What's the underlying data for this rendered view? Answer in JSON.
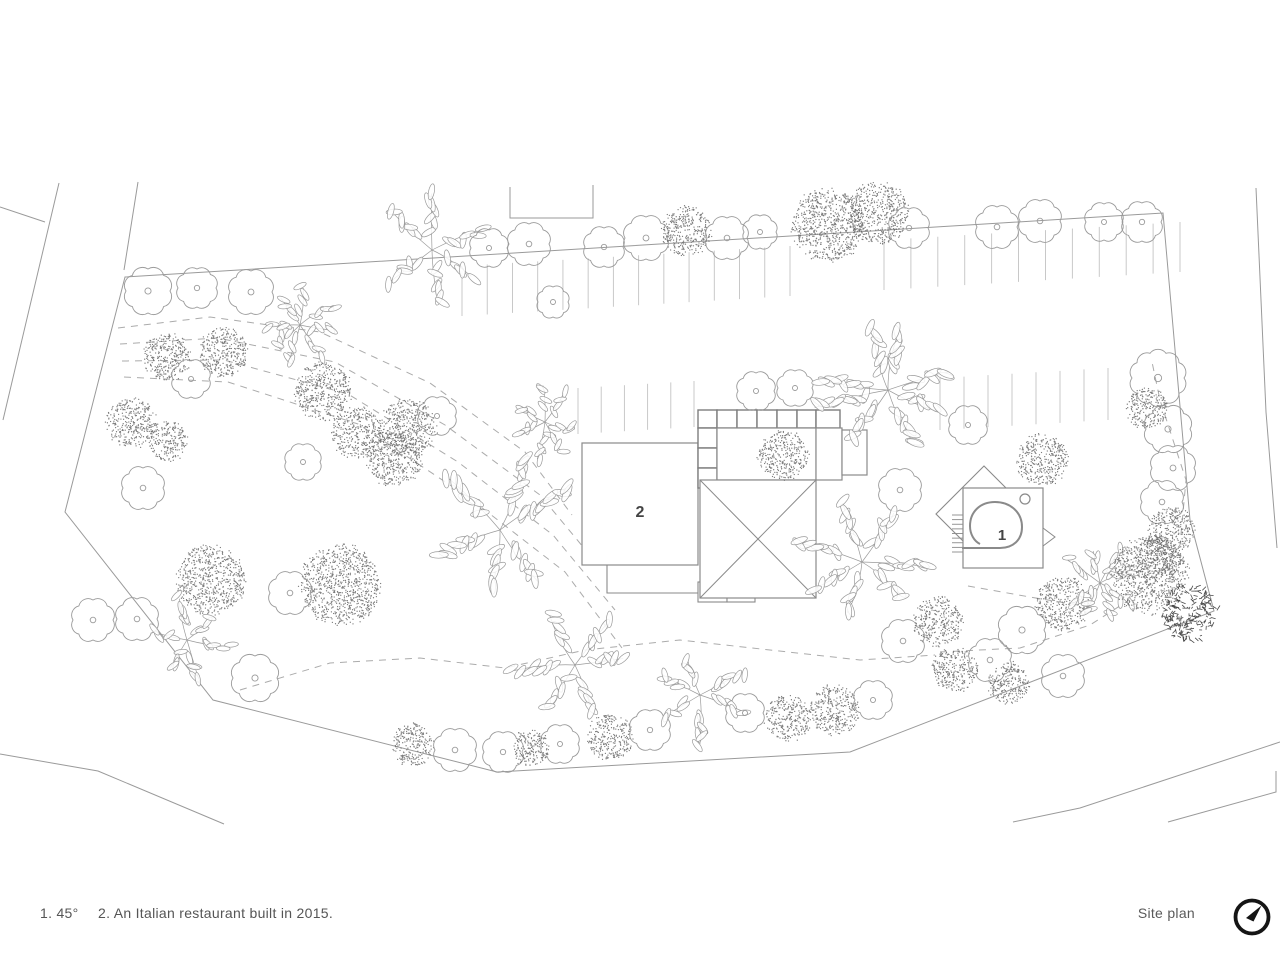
{
  "footer": {
    "note1": "1. 45°",
    "note2": "2. An Italian restaurant built in 2015.",
    "title": "Site plan",
    "north_icon": "north-arrow"
  },
  "colors": {
    "line": "#9a9a9a",
    "building_line": "#8a8a8a",
    "grid_line": "#7d7d7d",
    "parking": "#c3c3c3",
    "dash": "#ababab",
    "stipple": "#666666",
    "dark_tree": "#4a4a4a",
    "label_text": "#444444",
    "footer_text": "#555555",
    "north": "#151515",
    "background": "#ffffff"
  },
  "plan": {
    "boundary": [
      [
        125,
        277
      ],
      [
        1163,
        213
      ],
      [
        1190,
        520
      ],
      [
        1214,
        611
      ],
      [
        850,
        752
      ],
      [
        497,
        772
      ],
      [
        213,
        700
      ],
      [
        65,
        512
      ]
    ],
    "boundary_ext": [
      [
        138,
        182
      ],
      [
        124,
        270
      ]
    ],
    "roads": [
      [
        [
          59,
          183
        ],
        [
          3,
          420
        ]
      ],
      [
        [
          0,
          207
        ],
        [
          45,
          222
        ]
      ],
      [
        [
          0,
          754
        ],
        [
          98,
          771
        ],
        [
          224,
          824
        ]
      ],
      [
        [
          1013,
          822
        ],
        [
          1080,
          808
        ],
        [
          1280,
          742
        ]
      ],
      [
        [
          1168,
          822
        ],
        [
          1276,
          792
        ],
        [
          1276,
          771
        ]
      ],
      [
        [
          1256,
          188
        ],
        [
          1261,
          300
        ],
        [
          1266,
          412
        ],
        [
          1277,
          548
        ]
      ]
    ],
    "entry_u": [
      [
        510,
        187
      ],
      [
        510,
        218
      ],
      [
        593,
        218
      ],
      [
        593,
        185
      ]
    ],
    "parking": [
      {
        "from": [
          462,
          266
        ],
        "to": [
          790,
          246
        ],
        "n": 13,
        "len": 50
      },
      {
        "from": [
          884,
          240
        ],
        "to": [
          1180,
          222
        ],
        "n": 11,
        "len": 50
      },
      {
        "from": [
          578,
          388
        ],
        "to": [
          694,
          381
        ],
        "n": 5,
        "len": 46
      },
      {
        "from": [
          940,
          378
        ],
        "to": [
          1108,
          368
        ],
        "n": 7,
        "len": 52
      }
    ],
    "paths": [
      [
        [
          118,
          328
        ],
        [
          210,
          317
        ],
        [
          320,
          332
        ],
        [
          430,
          383
        ],
        [
          525,
          452
        ],
        [
          572,
          515
        ]
      ],
      [
        [
          120,
          344
        ],
        [
          218,
          338
        ],
        [
          335,
          362
        ],
        [
          445,
          425
        ],
        [
          540,
          495
        ],
        [
          598,
          565
        ]
      ],
      [
        [
          122,
          361
        ],
        [
          224,
          360
        ],
        [
          348,
          394
        ],
        [
          458,
          462
        ],
        [
          553,
          535
        ],
        [
          615,
          610
        ]
      ],
      [
        [
          124,
          377
        ],
        [
          228,
          382
        ],
        [
          358,
          424
        ],
        [
          468,
          497
        ],
        [
          565,
          572
        ],
        [
          622,
          648
        ]
      ],
      [
        [
          240,
          690
        ],
        [
          330,
          663
        ],
        [
          420,
          658
        ],
        [
          505,
          668
        ],
        [
          585,
          650
        ],
        [
          680,
          640
        ],
        [
          770,
          650
        ],
        [
          860,
          660
        ],
        [
          935,
          655
        ]
      ],
      [
        [
          940,
          652
        ],
        [
          1020,
          648
        ],
        [
          1090,
          625
        ],
        [
          1145,
          590
        ],
        [
          1180,
          545
        ],
        [
          1186,
          480
        ],
        [
          1160,
          400
        ],
        [
          1152,
          362
        ]
      ],
      [
        [
          968,
          586
        ],
        [
          1030,
          597
        ],
        [
          1090,
          607
        ]
      ]
    ],
    "building2": {
      "label": "2",
      "label_pos": [
        640,
        517
      ],
      "rect": [
        582,
        443,
        116,
        122
      ],
      "step": [
        [
          607,
          565
        ],
        [
          607,
          593
        ],
        [
          698,
          593
        ]
      ],
      "cells": [
        [
          698,
          582,
          29,
          20
        ],
        [
          727,
          582,
          28,
          20
        ]
      ]
    },
    "grid_building": {
      "top_cells_x": [
        698,
        717,
        737,
        757,
        777,
        797,
        816,
        840
      ],
      "top_cells_y": [
        410,
        428
      ],
      "left_cells_x": [
        698,
        717
      ],
      "left_cells_y": [
        428,
        448,
        468,
        488
      ],
      "courtyard": [
        717,
        428,
        99,
        52
      ],
      "right_wing": [
        816,
        428,
        26,
        52
      ],
      "annex": [
        842,
        430,
        25,
        45
      ],
      "roof_rect": [
        700,
        480,
        116,
        118
      ],
      "roof_apex": [
        758,
        539
      ],
      "courtyard_tree": [
        783,
        455,
        26
      ]
    },
    "building1": {
      "label": "1",
      "label_pos": [
        1002,
        540
      ],
      "diamond_center": [
        984,
        514
      ],
      "diamond_half": 48,
      "square": [
        963,
        488,
        80,
        80
      ],
      "circle": [
        1025,
        499,
        5
      ],
      "spiral": "M 962 548 L 1000 548 C 1013 548 1022 540 1022 527 C 1022 512 1010 502 995 502 C 980 502 970 512 970 526 C 970 534 974 541 980 544",
      "stairs": {
        "x1": 952,
        "x2": 963,
        "y1": 515,
        "y2": 552,
        "n": 8
      },
      "triangle": [
        [
          1043,
          528
        ],
        [
          1043,
          546
        ],
        [
          1055,
          537
        ]
      ]
    },
    "trees": [
      [
        "o",
        148,
        291,
        22
      ],
      [
        "o",
        197,
        288,
        19
      ],
      [
        "o",
        251,
        292,
        21
      ],
      [
        "l",
        432,
        250,
        58
      ],
      [
        "o",
        489,
        248,
        18
      ],
      [
        "o",
        529,
        244,
        20
      ],
      [
        "o",
        553,
        302,
        15
      ],
      [
        "o",
        604,
        247,
        19
      ],
      [
        "o",
        646,
        238,
        21
      ],
      [
        "s",
        686,
        231,
        26
      ],
      [
        "o",
        727,
        238,
        20
      ],
      [
        "o",
        760,
        232,
        16
      ],
      [
        "s",
        828,
        225,
        38
      ],
      [
        "s",
        878,
        213,
        32
      ],
      [
        "o",
        909,
        228,
        19
      ],
      [
        "o",
        997,
        227,
        20
      ],
      [
        "o",
        1040,
        221,
        20
      ],
      [
        "o",
        1104,
        222,
        18
      ],
      [
        "o",
        1142,
        222,
        19
      ],
      [
        "s",
        131,
        423,
        26
      ],
      [
        "s",
        167,
        357,
        25
      ],
      [
        "s",
        223,
        352,
        26
      ],
      [
        "o",
        191,
        379,
        18
      ],
      [
        "s",
        168,
        442,
        21
      ],
      [
        "o",
        143,
        488,
        20
      ],
      [
        "s",
        210,
        580,
        36
      ],
      [
        "s",
        340,
        585,
        42
      ],
      [
        "o",
        290,
        593,
        20
      ],
      [
        "o",
        93,
        620,
        20
      ],
      [
        "o",
        137,
        619,
        20
      ],
      [
        "l",
        187,
        640,
        42
      ],
      [
        "o",
        255,
        678,
        22
      ],
      [
        "l",
        300,
        325,
        40
      ],
      [
        "s",
        323,
        391,
        30
      ],
      [
        "s",
        357,
        433,
        27
      ],
      [
        "s",
        394,
        459,
        29
      ],
      [
        "o",
        303,
        462,
        17
      ],
      [
        "s",
        408,
        428,
        30
      ],
      [
        "o",
        437,
        416,
        18
      ],
      [
        "l",
        545,
        422,
        36
      ],
      [
        "l",
        500,
        530,
        78
      ],
      [
        "l",
        575,
        665,
        62
      ],
      [
        "s",
        413,
        745,
        22
      ],
      [
        "o",
        455,
        750,
        20
      ],
      [
        "o",
        503,
        752,
        19
      ],
      [
        "s",
        530,
        748,
        20
      ],
      [
        "o",
        560,
        744,
        18
      ],
      [
        "s",
        610,
        737,
        24
      ],
      [
        "o",
        650,
        730,
        19
      ],
      [
        "l",
        700,
        695,
        48
      ],
      [
        "o",
        745,
        713,
        18
      ],
      [
        "s",
        788,
        718,
        24
      ],
      [
        "s",
        835,
        710,
        26
      ],
      [
        "o",
        873,
        700,
        18
      ],
      [
        "o",
        756,
        391,
        18
      ],
      [
        "o",
        795,
        388,
        17
      ],
      [
        "l",
        888,
        390,
        72
      ],
      [
        "o",
        968,
        425,
        18
      ],
      [
        "s",
        1043,
        460,
        27
      ],
      [
        "o",
        900,
        490,
        20
      ],
      [
        "l",
        862,
        562,
        66
      ],
      [
        "s",
        938,
        622,
        26
      ],
      [
        "o",
        903,
        641,
        20
      ],
      [
        "s",
        955,
        670,
        24
      ],
      [
        "o",
        990,
        660,
        20
      ],
      [
        "s",
        1008,
        683,
        22
      ],
      [
        "o",
        1022,
        630,
        22
      ],
      [
        "s",
        1063,
        603,
        28
      ],
      [
        "l",
        1100,
        583,
        40
      ],
      [
        "s",
        1150,
        575,
        40
      ],
      [
        "d",
        1189,
        612,
        28
      ],
      [
        "o",
        1063,
        676,
        20
      ],
      [
        "o",
        1158,
        378,
        26
      ],
      [
        "s",
        1147,
        408,
        22
      ],
      [
        "o",
        1168,
        429,
        22
      ],
      [
        "o",
        1173,
        468,
        21
      ],
      [
        "o",
        1162,
        502,
        20
      ],
      [
        "s",
        1172,
        530,
        24
      ],
      [
        "s",
        1158,
        558,
        24
      ]
    ]
  }
}
